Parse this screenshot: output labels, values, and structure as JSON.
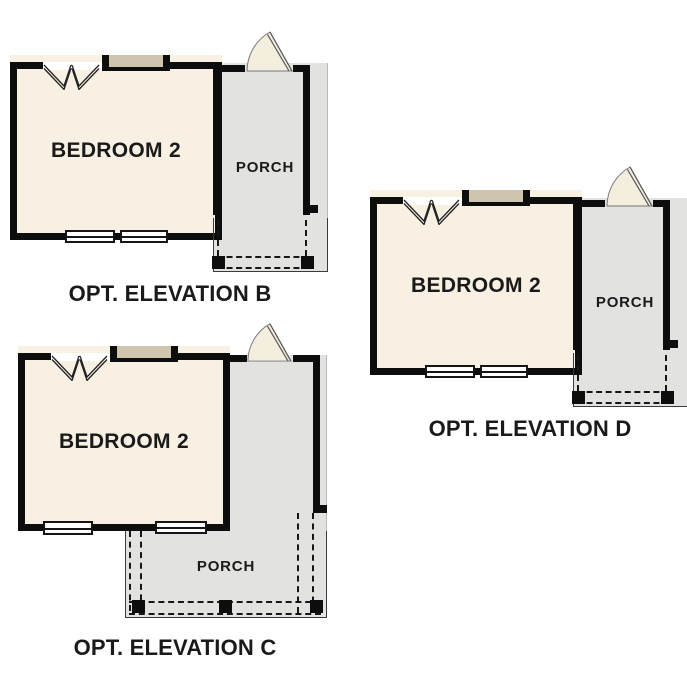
{
  "colors": {
    "background": "#ffffff",
    "bedroom-fill": "#f7f0e3",
    "porch-fill": "#e2e2e0",
    "wall": "#0d0d0d",
    "header-bar": "#cfc4ae",
    "door-fill": "#f4eedf",
    "text": "#1a1a1a"
  },
  "plans": [
    {
      "id": "B",
      "bedroom_label": "BEDROOM 2",
      "porch_label": "PORCH",
      "caption": "OPT. ELEVATION B"
    },
    {
      "id": "C",
      "bedroom_label": "BEDROOM 2",
      "porch_label": "PORCH",
      "caption": "OPT. ELEVATION C"
    },
    {
      "id": "D",
      "bedroom_label": "BEDROOM 2",
      "porch_label": "PORCH",
      "caption": "OPT. ELEVATION D"
    }
  ]
}
